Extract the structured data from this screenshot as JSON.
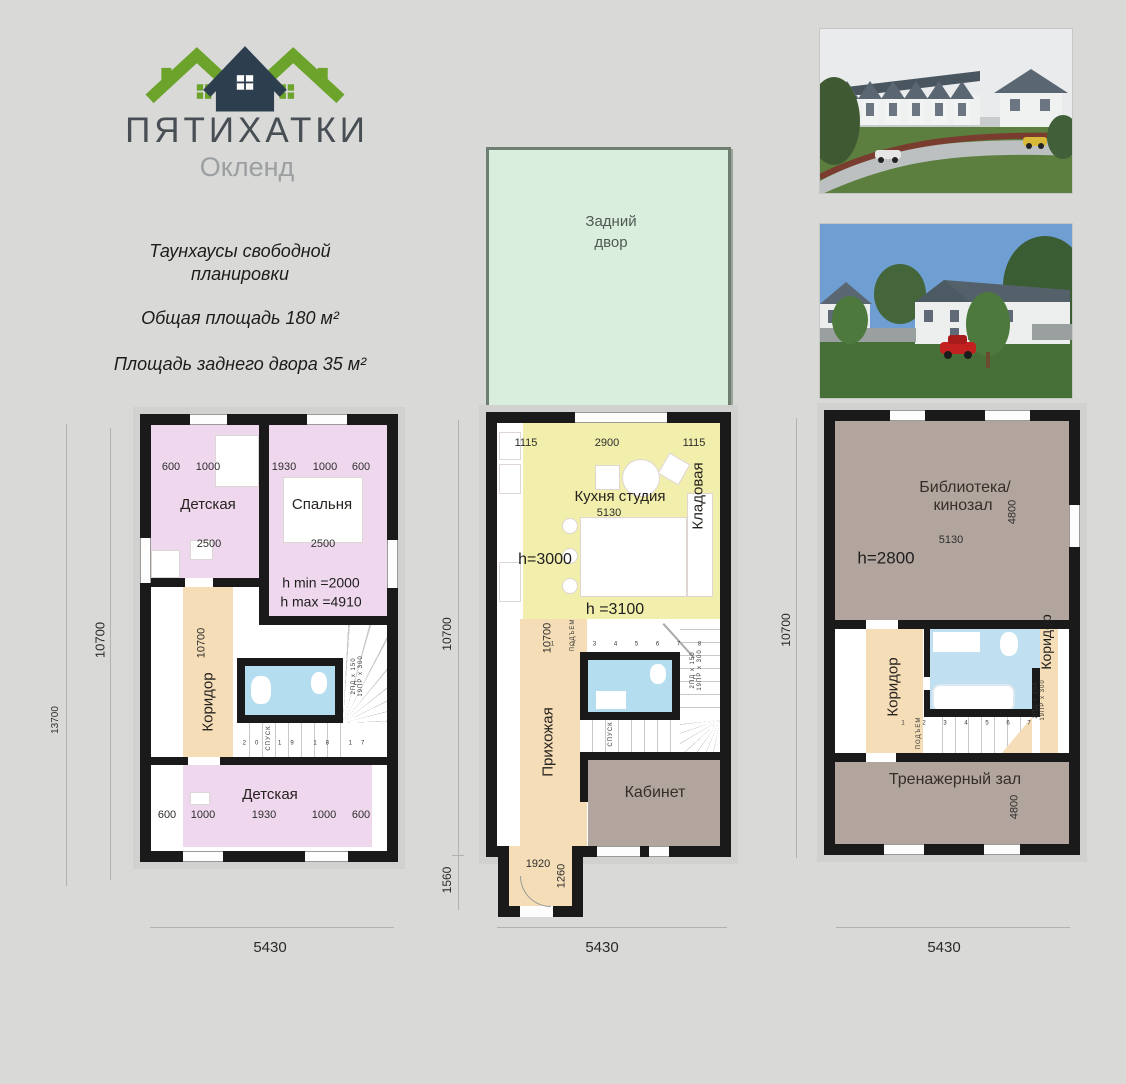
{
  "logo": {
    "brand": "ПЯТИХАТКИ",
    "subtitle": "Окленд"
  },
  "description": {
    "line1": "Таунхаусы свободной",
    "line2": "планировки",
    "line3": "Общая площадь 180 м²",
    "line4": "Площадь заднего двора 35 м²"
  },
  "colors": {
    "background": "#d9d9d7",
    "wall": "#1a1a1a",
    "pink": "#efd7ed",
    "beige": "#f4ddb7",
    "blue": "#b5ddf0",
    "yellow": "#f2eeab",
    "yard_green": "#daeede",
    "taupe": "#b2a59d",
    "logo_green": "#6ba32b",
    "logo_navy": "#2d3e4f"
  },
  "plan_attic": {
    "title_room_tl": "Детская",
    "title_room_tr": "Спальня",
    "dim_tl_1": "600",
    "dim_tl_2": "1000",
    "dim_tl_w": "2500",
    "dim_tr_1": "1930",
    "dim_tr_2": "1000",
    "dim_tr_3": "600",
    "dim_tr_w": "2500",
    "h_min": "h min =2000",
    "h_max": "h max =4910",
    "corridor": "Коридор",
    "corridor_dim": "10700",
    "room_bottom": "Детская",
    "dim_b_1": "600",
    "dim_b_2": "1000",
    "dim_b_3": "1930",
    "dim_b_4": "1000",
    "dim_b_5": "600",
    "stair_numbers": "20 19 18 17",
    "stair_down": "СПУСК",
    "stair_note1": "2ПД x 150",
    "stair_note2": "19ПР x 300",
    "dim_left_outer": "13700",
    "dim_left_inner": "10700",
    "dim_width": "5430"
  },
  "plan_ground": {
    "backyard1": "Задний",
    "backyard2": "двор",
    "dim_t_1": "1115",
    "dim_t_2": "2900",
    "dim_t_3": "1115",
    "kitchen": "Кухня студия",
    "kitchen_dim": "5130",
    "pantry": "Кладовая",
    "h_kitchen": "h=3000",
    "h_mid": "h =3100",
    "hall": "Прихожая",
    "hall_dim": "10700",
    "office": "Кабинет",
    "entry_w": "1920",
    "entry_d": "1260",
    "stair_numbers": "1 2 3 4 5 6 7 8",
    "stair_up": "ПОДЪЕМ",
    "stair_down": "СПУСК",
    "stair_note1": "2ПД x 150",
    "stair_note2": "19ПР x 300",
    "dim_left_upper": "10700",
    "dim_left_lower": "1560",
    "dim_width": "5430"
  },
  "plan_second": {
    "library1": "Библиотека/",
    "library2": "кинозал",
    "library_dim_v": "4800",
    "library_dim_w": "5130",
    "h_label": "h=2800",
    "corridor_left": "Коридор",
    "corridor_right": "Коридор",
    "gym": "Тренажерный зал",
    "gym_dim": "4800",
    "stair_numbers": "1 2 3 4 5 6 7",
    "stair_up": "ПОДЪЕМ",
    "stair_note1": "2ПД x 150",
    "stair_note2": "19ПР x 300",
    "dim_left": "10700",
    "dim_width": "5430"
  }
}
